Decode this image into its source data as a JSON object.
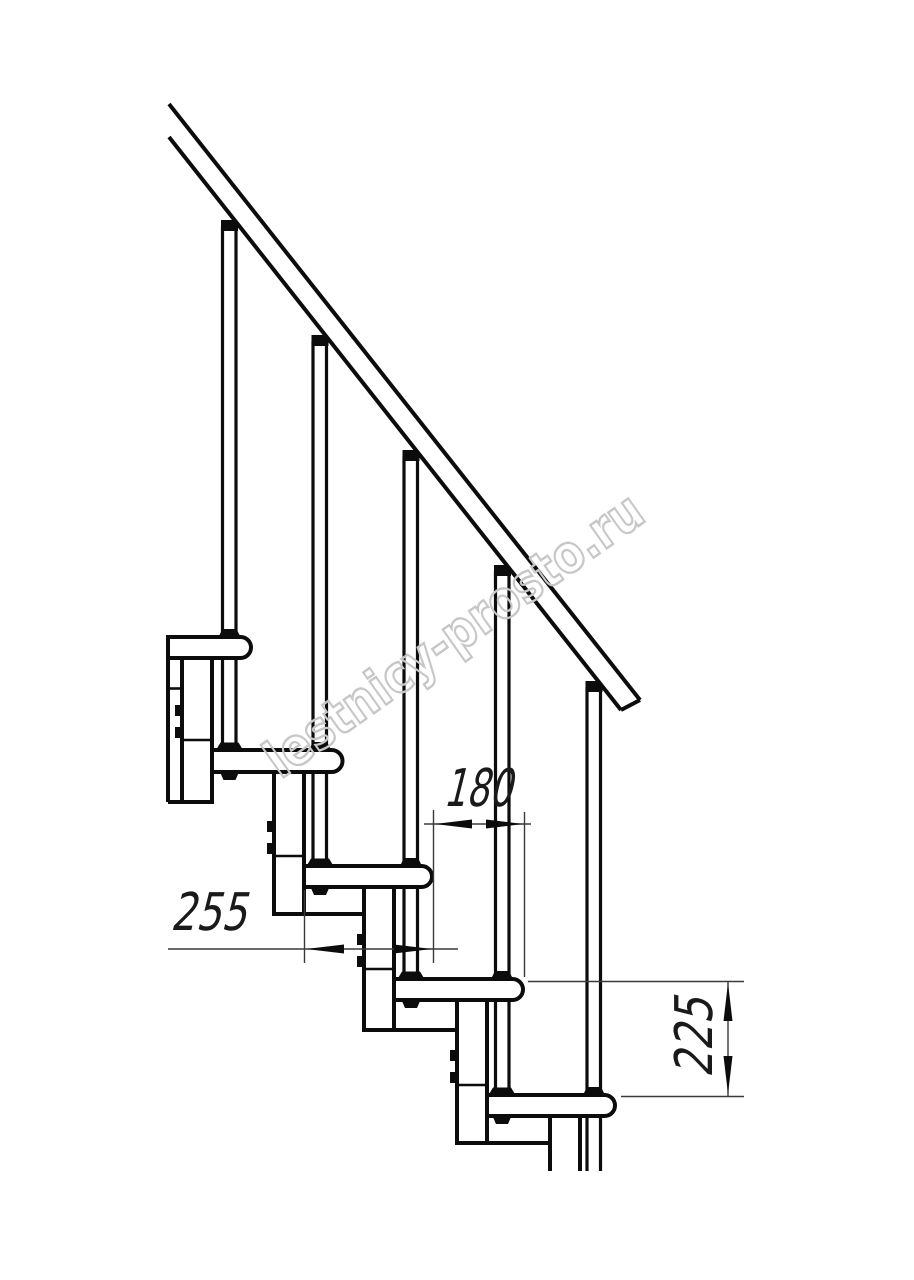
{
  "drawing": {
    "kind": "staircase-fragment-side-view",
    "treads_visible": 5,
    "balusters_visible": 5,
    "colors": {
      "line": "#0c0c0c",
      "dimension_line": "#3a3a3a",
      "watermark": "#c7c7c7",
      "background": "#ffffff"
    }
  },
  "dimensions": {
    "step_run": "180",
    "tread_depth": "255",
    "step_rise": "225"
  },
  "watermark": {
    "text": "lestnicy-prosto.ru"
  }
}
